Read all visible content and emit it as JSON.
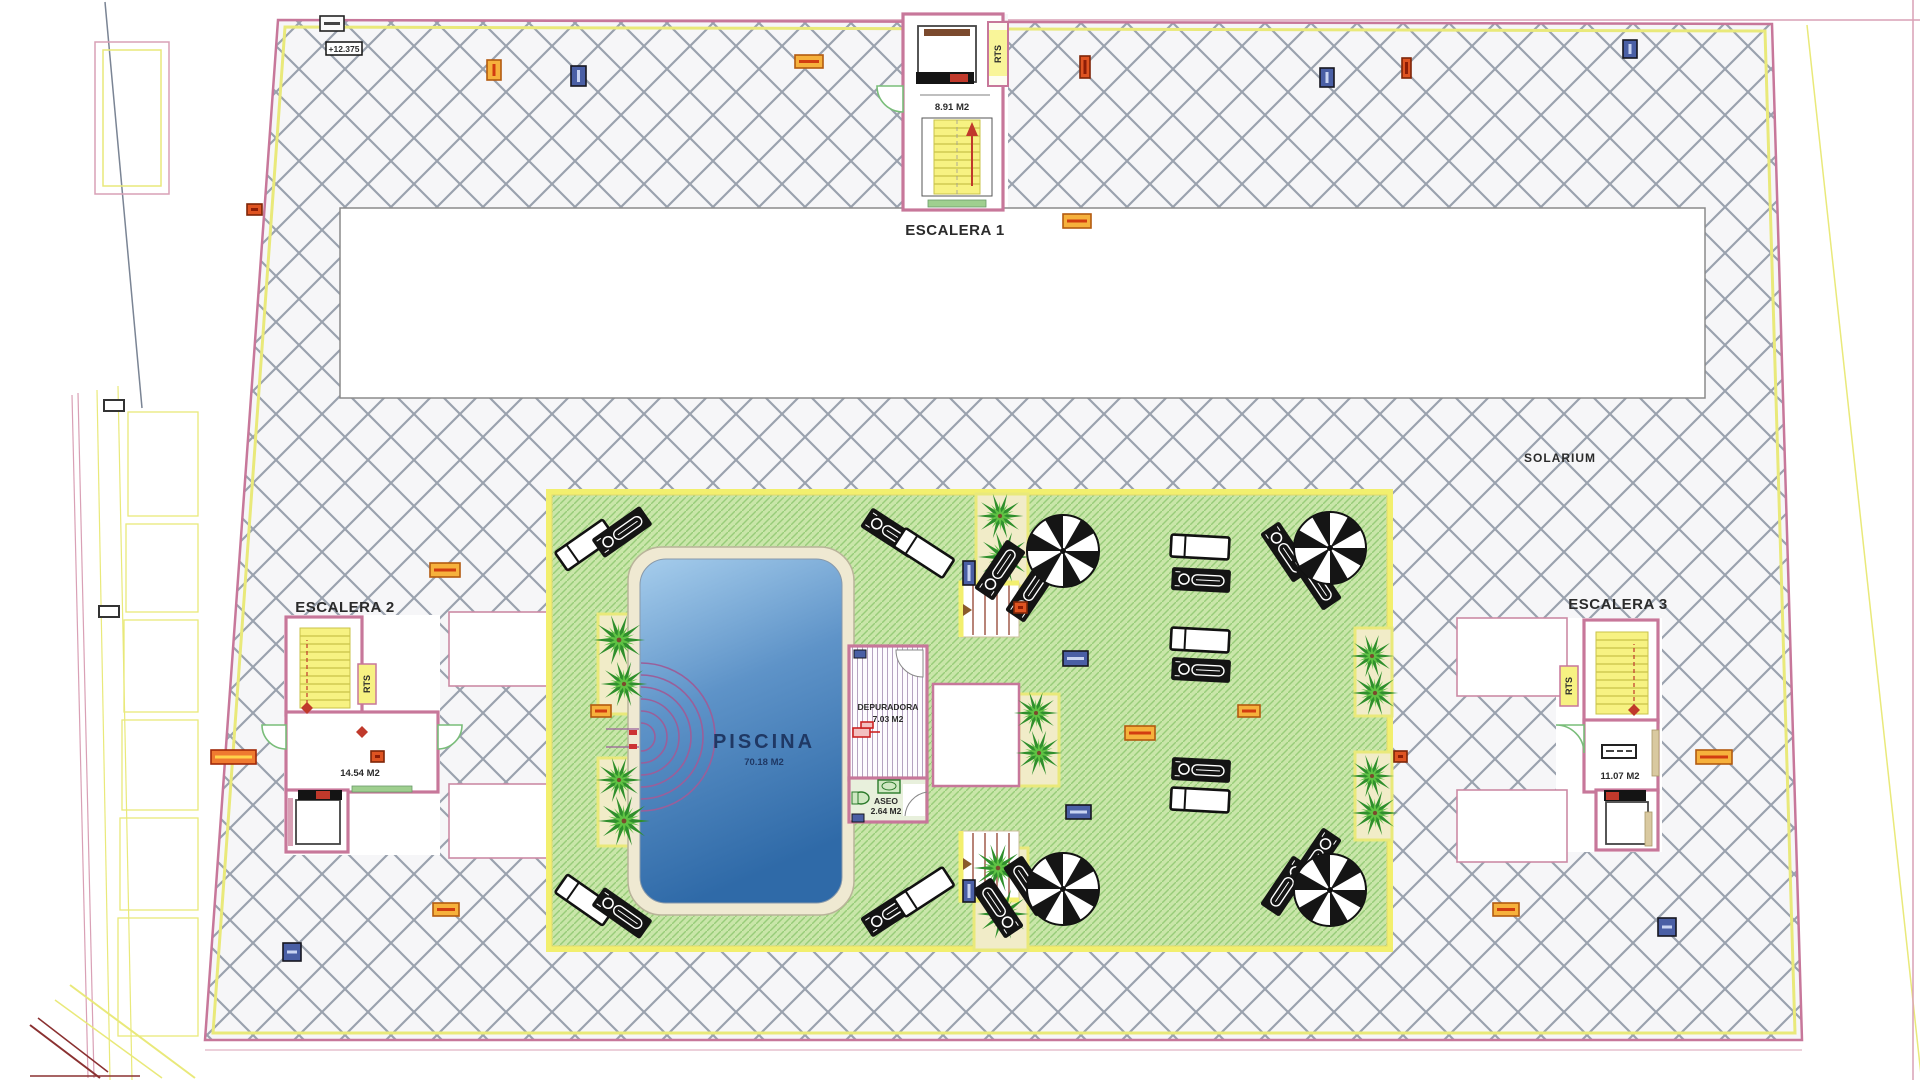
{
  "title": "Roof solarium floor plan",
  "labels": {
    "escalera1": "ESCALERA 1",
    "escalera2": "ESCALERA 2",
    "escalera3": "ESCALERA 3",
    "solarium": "SOLARIUM",
    "piscina": "PISCINA",
    "piscina_area": "70.18 M2",
    "esc1_area": "8.91 M2",
    "esc2_area": "14.54 M2",
    "esc3_area": "11.07 M2",
    "depuradora": "DEPURADORA",
    "depuradora_area": "7.03 M2",
    "aseo": "ASEO",
    "aseo_area": "2.64 M2",
    "rts": "RTS",
    "elevation": "+12.375"
  },
  "colors": {
    "boundary_pink": "#c7779a",
    "boundary_yellow": "#e9e97a",
    "hatch_line": "#9aa2ae",
    "hatch_bg": "#f6f6f8",
    "deck_green": "#c9e6a9",
    "deck_line": "#98cc79",
    "pool_top": "#a6cdec",
    "pool_bottom": "#2f6aa8",
    "tread_yellow": "#f7f282",
    "marker_orange": "#f6b13c",
    "marker_navy": "#4a5fa5",
    "marker_red": "#df5422"
  },
  "furniture": {
    "planters": [
      [
        598,
        614,
        46,
        100
      ],
      [
        598,
        758,
        46,
        88
      ],
      [
        976,
        494,
        52,
        92
      ],
      [
        974,
        848,
        54,
        102
      ],
      [
        1019,
        694,
        40,
        92
      ],
      [
        1355,
        628,
        37,
        88
      ],
      [
        1355,
        752,
        37,
        88
      ]
    ],
    "palms": [
      [
        619,
        640,
        1
      ],
      [
        624,
        684,
        0.9
      ],
      [
        619,
        780,
        0.9
      ],
      [
        624,
        821,
        1
      ],
      [
        1000,
        516,
        0.9
      ],
      [
        1004,
        557,
        1
      ],
      [
        998,
        868,
        0.95
      ],
      [
        1003,
        914,
        1
      ],
      [
        1036,
        713,
        0.85
      ],
      [
        1039,
        753,
        0.9
      ],
      [
        1372,
        656,
        0.85
      ],
      [
        1375,
        693,
        0.9
      ],
      [
        1372,
        776,
        0.85
      ],
      [
        1375,
        813,
        0.9
      ]
    ],
    "loungers": [
      [
        "white",
        585,
        545,
        -35
      ],
      [
        "person",
        622,
        532,
        -35
      ],
      [
        "person",
        891,
        533,
        33
      ],
      [
        "white",
        924,
        553,
        33
      ],
      [
        "person",
        1000,
        570,
        -56
      ],
      [
        "person",
        1031,
        592,
        -56
      ],
      [
        "white",
        1200,
        547,
        3
      ],
      [
        "person",
        1201,
        580,
        3
      ],
      [
        "white",
        1200,
        640,
        3
      ],
      [
        "person",
        1201,
        670,
        3
      ],
      [
        "person",
        1286,
        552,
        56
      ],
      [
        "person",
        1316,
        580,
        56
      ],
      [
        "white",
        585,
        900,
        35
      ],
      [
        "person",
        622,
        913,
        35
      ],
      [
        "person",
        891,
        912,
        -33
      ],
      [
        "white",
        924,
        892,
        -33
      ],
      [
        "person",
        998,
        908,
        -124
      ],
      [
        "person",
        1029,
        886,
        -124
      ],
      [
        "person",
        1201,
        770,
        3
      ],
      [
        "white",
        1200,
        800,
        3
      ],
      [
        "person",
        1286,
        886,
        124
      ],
      [
        "person",
        1316,
        858,
        124
      ]
    ],
    "umbrellas": [
      [
        1063,
        551
      ],
      [
        1330,
        548
      ],
      [
        1063,
        889
      ],
      [
        1330,
        890
      ]
    ]
  },
  "markers": [
    [
      "dark",
      320,
      16,
      24,
      15
    ],
    [
      "orange",
      487,
      60,
      14,
      20
    ],
    [
      "navy",
      571,
      66,
      15,
      20
    ],
    [
      "orange",
      795,
      55,
      28,
      13
    ],
    [
      "red",
      1080,
      56,
      10,
      22
    ],
    [
      "navy",
      1320,
      68,
      14,
      19
    ],
    [
      "red",
      1402,
      58,
      9,
      20
    ],
    [
      "navy",
      1623,
      40,
      14,
      18
    ],
    [
      "orange",
      1063,
      214,
      28,
      14
    ],
    [
      "red",
      247,
      204,
      15,
      11
    ],
    [
      "orange",
      430,
      563,
      30,
      14
    ],
    [
      "orange",
      591,
      705,
      20,
      12
    ],
    [
      "navy",
      963,
      561,
      12,
      24
    ],
    [
      "red",
      1014,
      602,
      13,
      11
    ],
    [
      "orange",
      1238,
      705,
      22,
      12
    ],
    [
      "orange",
      1125,
      726,
      30,
      14
    ],
    [
      "navy",
      1063,
      651,
      25,
      15
    ],
    [
      "navy",
      1066,
      805,
      25,
      14
    ],
    [
      "navy",
      963,
      880,
      12,
      22
    ],
    [
      "red",
      371,
      751,
      13,
      11
    ],
    [
      "red",
      1394,
      751,
      13,
      11
    ],
    [
      "redlong",
      211,
      750,
      45,
      14
    ],
    [
      "orange",
      1696,
      750,
      36,
      14
    ],
    [
      "orange",
      433,
      903,
      26,
      13
    ],
    [
      "navy",
      283,
      943,
      18,
      18
    ],
    [
      "orange",
      1493,
      903,
      26,
      13
    ],
    [
      "navy",
      1658,
      918,
      18,
      18
    ]
  ]
}
